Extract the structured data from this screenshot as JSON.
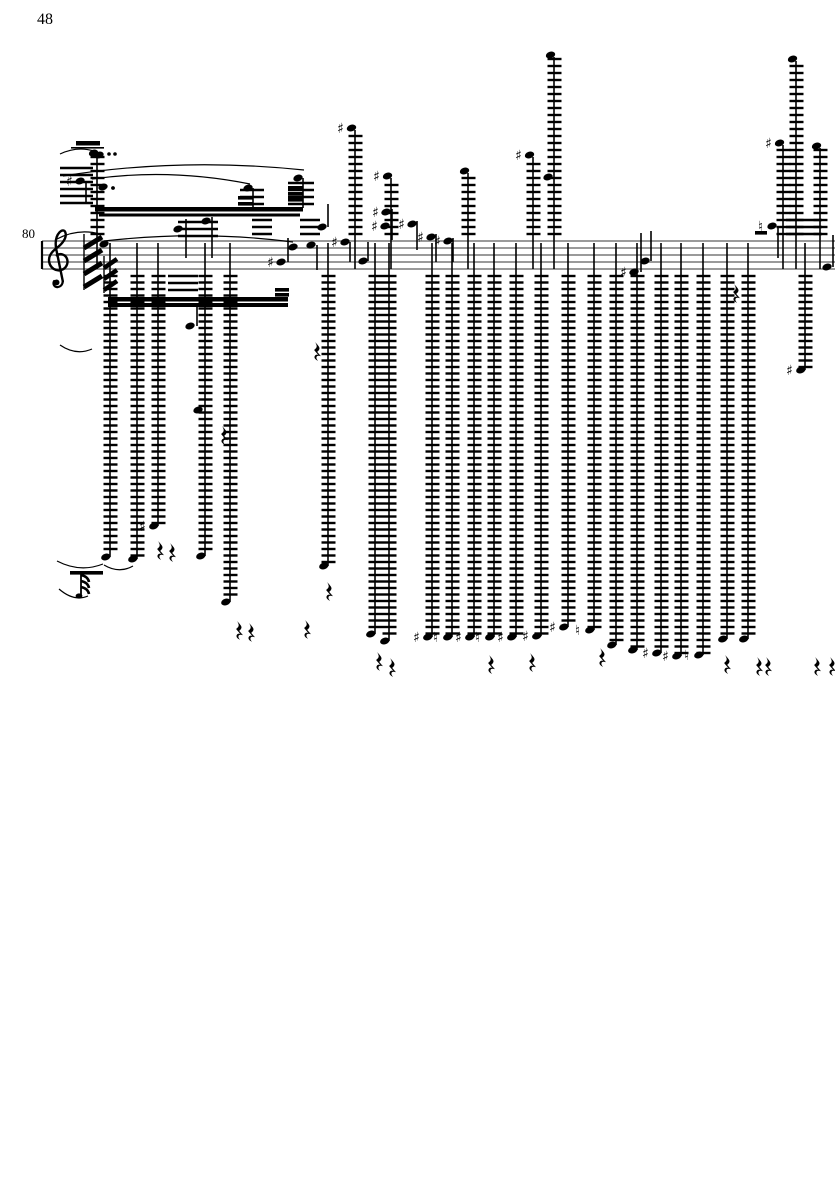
{
  "page": {
    "number": "48",
    "background": "#ffffff",
    "ink": "#000000",
    "staff_color": "#787878"
  },
  "score": {
    "measure_number": "80",
    "clef": "treble",
    "staff": {
      "x1": 42,
      "x2": 835,
      "top": 241,
      "gap": 7,
      "lines": 5,
      "barline_x": 42
    },
    "accidental_sharp": "♯",
    "accidental_natural": "♮",
    "above_columns": [
      {
        "x": 97,
        "top": 153
      },
      {
        "x": 355,
        "top": 128,
        "acc": "♯"
      },
      {
        "x": 391,
        "top": 176,
        "acc": "♯"
      },
      {
        "x": 468,
        "top": 171
      },
      {
        "x": 533,
        "top": 155,
        "acc": "♯"
      },
      {
        "x": 554,
        "top": 55
      },
      {
        "x": 783,
        "top": 143,
        "acc": "♯"
      },
      {
        "x": 796,
        "top": 59
      },
      {
        "x": 820,
        "top": 146
      }
    ],
    "below_columns": [
      {
        "x": 110,
        "bot": 557
      },
      {
        "x": 137,
        "bot": 559
      },
      {
        "x": 158,
        "bot": 526,
        "acc": "♯"
      },
      {
        "x": 205,
        "bot": 556
      },
      {
        "x": 230,
        "bot": 602
      },
      {
        "x": 328,
        "bot": 566
      },
      {
        "x": 375,
        "bot": 634
      },
      {
        "x": 389,
        "bot": 641
      },
      {
        "x": 432,
        "bot": 637,
        "acc": "♯"
      },
      {
        "x": 452,
        "bot": 637,
        "acc": "♮"
      },
      {
        "x": 474,
        "bot": 637,
        "acc": "♯"
      },
      {
        "x": 494,
        "bot": 637,
        "acc": "♮"
      },
      {
        "x": 516,
        "bot": 637,
        "acc": "♯"
      },
      {
        "x": 541,
        "bot": 636,
        "acc": "♯"
      },
      {
        "x": 568,
        "bot": 627,
        "acc": "♯"
      },
      {
        "x": 594,
        "bot": 630,
        "acc": "♮"
      },
      {
        "x": 616,
        "bot": 645
      },
      {
        "x": 637,
        "bot": 650
      },
      {
        "x": 661,
        "bot": 653,
        "acc": "♯"
      },
      {
        "x": 681,
        "bot": 656,
        "acc": "♯"
      },
      {
        "x": 703,
        "bot": 655,
        "acc": "♮"
      },
      {
        "x": 727,
        "bot": 639
      },
      {
        "x": 748,
        "bot": 639
      },
      {
        "x": 805,
        "bot": 370,
        "acc": "♯"
      }
    ],
    "staff_notes": [
      {
        "x": 99,
        "y": 155
      },
      {
        "x": 80,
        "y": 181,
        "acc": "♯",
        "stem": [
          86,
          183,
          204
        ]
      },
      {
        "x": 103,
        "y": 187,
        "dot": true
      },
      {
        "x": 178,
        "y": 229,
        "stem": [
          186,
          219,
          258
        ]
      },
      {
        "x": 206,
        "y": 221,
        "stem": [
          212,
          217,
          258
        ]
      },
      {
        "x": 248,
        "y": 188,
        "stem": [
          253,
          188,
          208
        ]
      },
      {
        "x": 298,
        "y": 178,
        "stem": [
          303,
          178,
          208
        ]
      },
      {
        "x": 281,
        "y": 262,
        "acc": "♯",
        "stem": [
          288,
          238,
          262
        ]
      },
      {
        "x": 293,
        "y": 247
      },
      {
        "x": 104,
        "y": 244
      },
      {
        "x": 311,
        "y": 245,
        "stem": [
          317,
          245,
          270
        ]
      },
      {
        "x": 322,
        "y": 227,
        "stem": [
          328,
          204,
          227
        ]
      },
      {
        "x": 345,
        "y": 242,
        "acc": "♯",
        "stem": [
          350,
          242,
          262
        ]
      },
      {
        "x": 363,
        "y": 261,
        "stem": [
          368,
          242,
          261
        ]
      },
      {
        "x": 386,
        "y": 212,
        "acc": "♯"
      },
      {
        "x": 385,
        "y": 226,
        "acc": "♯",
        "stem": [
          392,
          209,
          240
        ]
      },
      {
        "x": 412,
        "y": 224,
        "acc": "♯",
        "stem": [
          417,
          221,
          250
        ]
      },
      {
        "x": 431,
        "y": 237,
        "acc": "♯",
        "stem": [
          436,
          234,
          262
        ]
      },
      {
        "x": 448,
        "y": 241,
        "acc": "♯",
        "stem": [
          453,
          238,
          262
        ]
      },
      {
        "x": 548,
        "y": 177
      },
      {
        "x": 634,
        "y": 272,
        "acc": "♯",
        "stem": [
          641,
          233,
          272
        ]
      },
      {
        "x": 645,
        "y": 261,
        "stem": [
          651,
          231,
          261
        ]
      },
      {
        "x": 772,
        "y": 226,
        "acc": "♮",
        "stem": [
          778,
          226,
          258
        ]
      },
      {
        "x": 827,
        "y": 267,
        "stem": [
          833,
          235,
          267
        ]
      },
      {
        "x": 190,
        "y": 326,
        "stem": [
          197,
          307,
          326
        ]
      },
      {
        "x": 198,
        "y": 410
      }
    ],
    "beams": [
      {
        "x1": 95,
        "y": 207,
        "x2": 303,
        "h": 4.5
      },
      {
        "x1": 99,
        "y": 213.5,
        "x2": 300,
        "h": 3
      },
      {
        "x1": 108,
        "y": 297,
        "x2": 288,
        "h": 4.5
      },
      {
        "x1": 108,
        "y": 303,
        "x2": 288,
        "h": 4
      }
    ],
    "beamlets": [
      {
        "x": 238,
        "y": 196,
        "w": 15
      },
      {
        "x": 238,
        "y": 202,
        "w": 15
      },
      {
        "x": 288,
        "y": 186,
        "w": 15
      },
      {
        "x": 288,
        "y": 192,
        "w": 15
      },
      {
        "x": 288,
        "y": 198,
        "w": 15
      },
      {
        "x": 275,
        "y": 288,
        "w": 14
      },
      {
        "x": 275,
        "y": 293,
        "w": 14
      },
      {
        "x": 755,
        "y": 231,
        "w": 12
      },
      {
        "x": 70,
        "y": 571,
        "w": 33
      }
    ],
    "slurs": [
      [
        60,
        154,
        77,
        146,
        94,
        151
      ],
      [
        63,
        176,
        180,
        157,
        304,
        170
      ],
      [
        92,
        179,
        170,
        168,
        250,
        184
      ],
      [
        57,
        239,
        78,
        228,
        100,
        234
      ],
      [
        104,
        241,
        200,
        230,
        293,
        242
      ],
      [
        60,
        345,
        76,
        356,
        92,
        349
      ],
      [
        57,
        561,
        80,
        573,
        103,
        564
      ],
      [
        104,
        565,
        119,
        574,
        133,
        566
      ],
      [
        59,
        589,
        74,
        602,
        88,
        596
      ]
    ],
    "rests": [
      [
        315,
        342
      ],
      [
        222,
        426
      ],
      [
        158,
        541
      ],
      [
        170,
        543
      ],
      [
        237,
        621
      ],
      [
        249,
        623
      ],
      [
        305,
        620
      ],
      [
        327,
        582
      ],
      [
        377,
        652
      ],
      [
        390,
        658
      ],
      [
        489,
        655
      ],
      [
        530,
        653
      ],
      [
        600,
        648
      ],
      [
        734,
        284
      ],
      [
        725,
        655
      ],
      [
        757,
        657
      ],
      [
        766,
        657
      ],
      [
        815,
        657
      ],
      [
        830,
        657
      ]
    ],
    "tremolos": [
      {
        "x": 84,
        "w": 18,
        "y0": 248,
        "n": 4,
        "gap": 13,
        "rise": 11,
        "sw": 5
      },
      {
        "x": 104,
        "w": 13,
        "y0": 268,
        "n": 3,
        "gap": 11,
        "rise": 9,
        "sw": 4.5
      }
    ],
    "dots": [
      [
        109,
        154
      ],
      [
        115,
        154
      ],
      [
        113,
        188
      ]
    ],
    "marcato": {
      "bar": [
        76,
        141,
        24,
        4.5
      ],
      "line": [
        71,
        147,
        33,
        1.6
      ]
    },
    "flag_note": {
      "stem": [
        81,
        573,
        596
      ],
      "flags": [
        [
          81,
          575
        ],
        [
          81,
          581
        ],
        [
          81,
          587
        ]
      ],
      "blob": [
        79,
        596
      ]
    },
    "ledger_patches": [
      {
        "x": 60,
        "w": 33,
        "y0": 168,
        "n": 6,
        "gap": 7
      },
      {
        "x": 240,
        "w": 24,
        "y0": 190,
        "n": 3,
        "gap": 7
      },
      {
        "x": 288,
        "w": 26,
        "y0": 183,
        "n": 4,
        "gap": 7
      },
      {
        "x": 252,
        "w": 20,
        "y0": 220,
        "n": 3,
        "gap": 7
      },
      {
        "x": 300,
        "w": 20,
        "y0": 220,
        "n": 3,
        "gap": 7
      },
      {
        "x": 178,
        "w": 40,
        "y0": 222,
        "n": 3,
        "gap": 7
      },
      {
        "x": 168,
        "w": 30,
        "y0": 276,
        "n": 3,
        "gap": 7
      },
      {
        "x": 786,
        "w": 36,
        "y0": 220,
        "n": 3,
        "gap": 7
      }
    ]
  }
}
